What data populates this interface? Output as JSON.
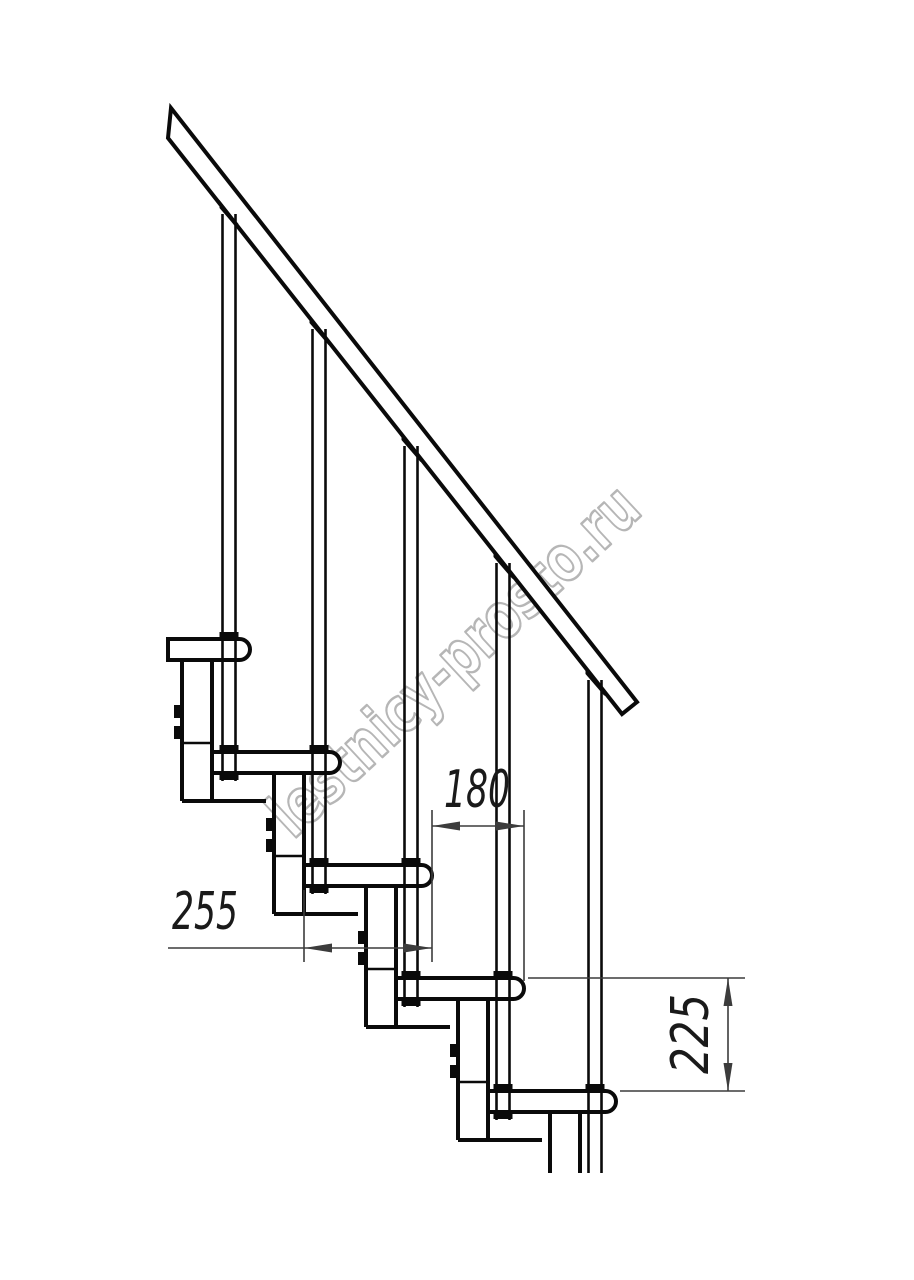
{
  "drawing": {
    "watermark": {
      "text": "lestnicy-prosto.ru"
    },
    "dimensions": {
      "tread_length": "255",
      "going": "180",
      "rise": "225"
    },
    "colors": {
      "background": "#ffffff",
      "line": "#0a0a0a",
      "dimension": "#3c3c3c",
      "watermark": "#b6b6b6"
    },
    "structure": {
      "treads_visible": 5,
      "balusters_visible": 5,
      "support_modules_visible": 5,
      "handrail": "diagonal handrail band, upper-left to mid-right"
    }
  }
}
